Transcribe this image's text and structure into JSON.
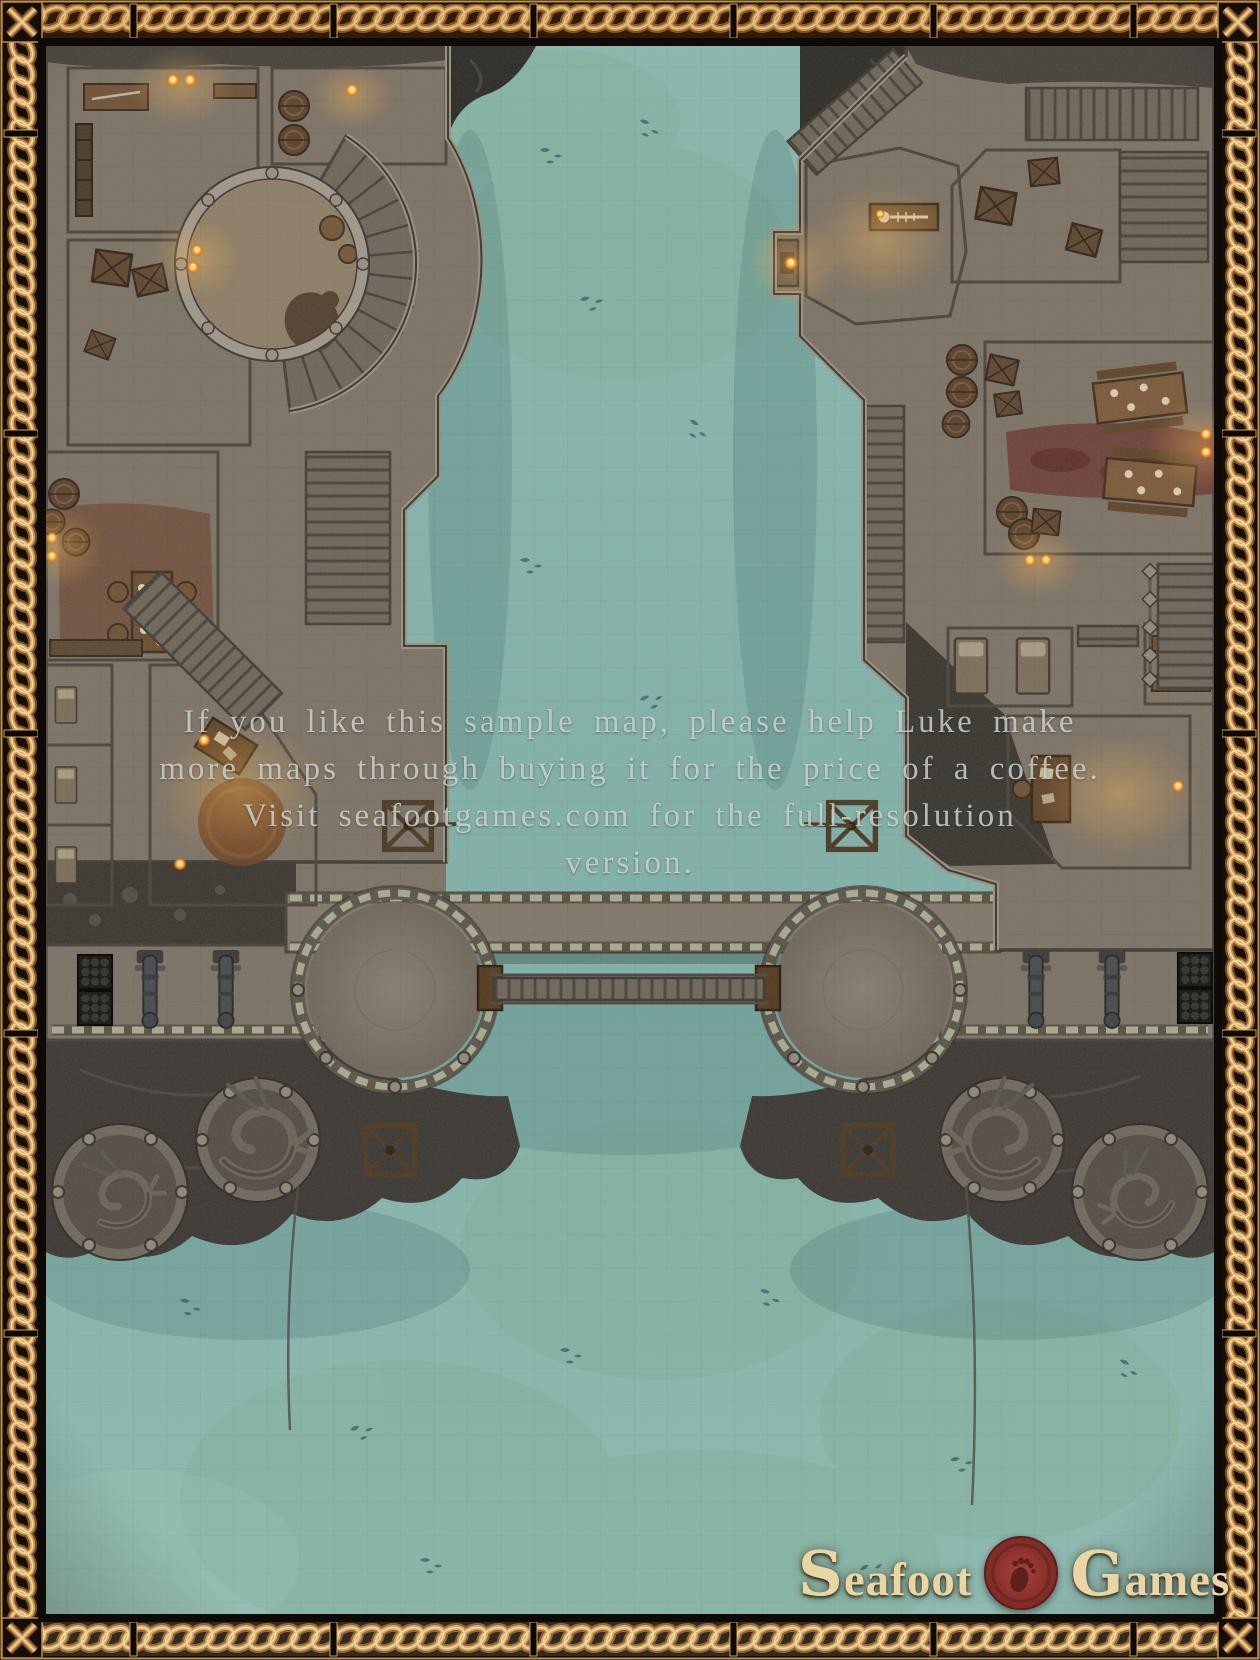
{
  "watermark": {
    "lines": [
      "If you like this sample map, please help Luke make",
      "more maps through buying it for the price of a coffee.",
      "Visit seafootgames.com for the full-resolution",
      "version."
    ]
  },
  "logo": {
    "word_left": "Seafoot",
    "word_right": "Games",
    "seal_icon": "footprint-wax-seal-icon"
  },
  "palette": {
    "border_gold": "#d3a561",
    "border_dark": "#160d07",
    "water_teal": "#84b4ab",
    "water_algae": "#7dac90",
    "stone_floor": "#7c7265",
    "stone_wall": "#9a9183",
    "warm_room_floor": "#8c7b63",
    "cliff_rock": "#3b3732",
    "wood_brown": "#6f5236",
    "carpet_red": "#6b3a31",
    "carpet_brown": "#6e4a33",
    "flame_orange": "#f1a033",
    "seal_red": "#8e332f",
    "logo_cream": "#e9d6a4",
    "watermark_text": "#d4d9d4"
  }
}
